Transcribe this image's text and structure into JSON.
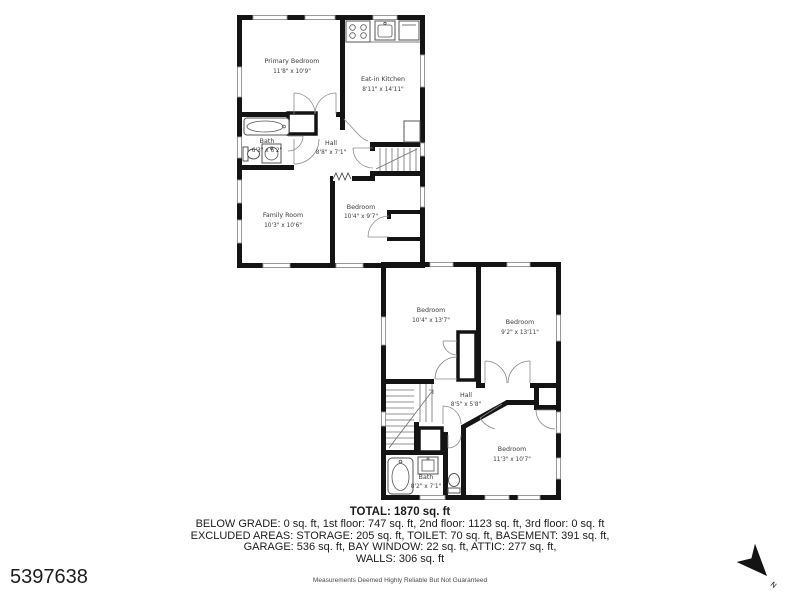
{
  "colors": {
    "wall": "#141414",
    "label": "#3b3b3b",
    "background": "#ffffff"
  },
  "floor1": {
    "rooms": [
      {
        "name": "Primary Bedroom",
        "dims": "11'8\" x 10'9\""
      },
      {
        "name": "Eat-in Kitchen",
        "dims": "8'11\" x 14'11\""
      },
      {
        "name": "Bath",
        "dims": "6'3\" x 6'2\""
      },
      {
        "name": "Hall",
        "dims": "8'8\" x 7'1\""
      },
      {
        "name": "Family Room",
        "dims": "10'3\" x 10'6\""
      },
      {
        "name": "Bedroom",
        "dims": "10'4\" x 9'7\""
      }
    ]
  },
  "floor2": {
    "rooms": [
      {
        "name": "Bedroom",
        "dims": "10'4\" x 13'7\""
      },
      {
        "name": "Bedroom",
        "dims": "9'2\" x 13'11\""
      },
      {
        "name": "Hall",
        "dims": "8'5\" x 5'8\""
      },
      {
        "name": "Bath",
        "dims": "8'2\" x 7'1\""
      },
      {
        "name": "Bedroom",
        "dims": "11'3\" x 10'7\""
      }
    ]
  },
  "summary": {
    "total": "TOTAL: 1870 sq. ft",
    "lines": [
      "BELOW GRADE: 0 sq. ft, 1st floor: 747 sq. ft, 2nd floor: 1123 sq. ft, 3rd floor: 0 sq. ft",
      "EXCLUDED AREAS: STORAGE: 205 sq. ft, TOILET: 70 sq. ft, BASEMENT: 391 sq. ft,",
      "GARAGE: 536 sq. ft, BAY WINDOW: 22 sq. ft, ATTIC: 277 sq. ft,",
      "WALLS: 306 sq. ft"
    ]
  },
  "footer": {
    "listing_id": "5397638",
    "disclaimer": "Measurements Deemed Highly Reliable But Not Guaranteed"
  },
  "compass": {
    "label": "N"
  }
}
